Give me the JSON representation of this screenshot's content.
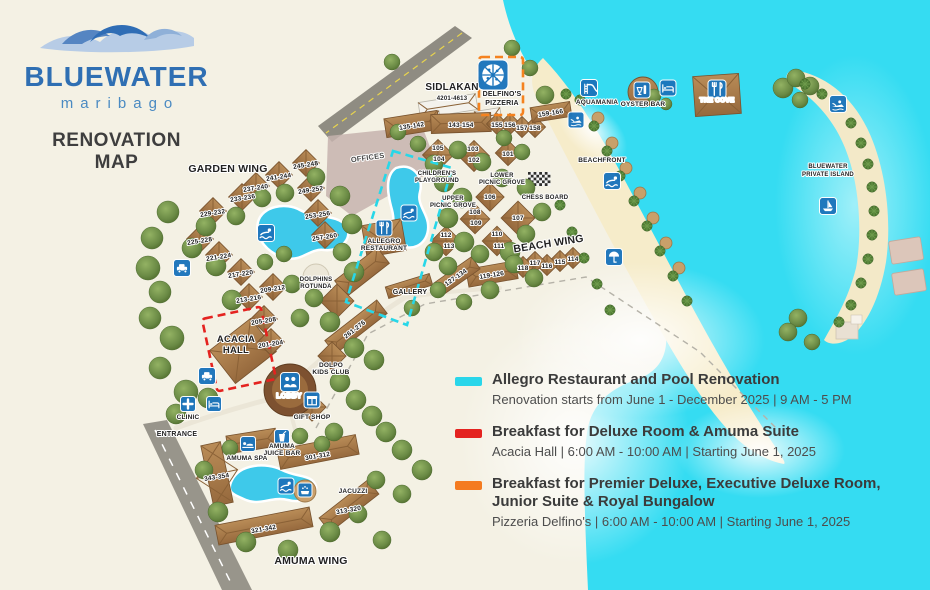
{
  "logo": {
    "brand": "BLUEWATER",
    "sub": "maribago",
    "title1": "RENOVATION",
    "title2": "MAP"
  },
  "legend": {
    "items": [
      {
        "color": "#29d6ea",
        "title": "Allegro Restaurant and Pool Renovation",
        "title2": "",
        "detail": "Renovation starts from June 1 - December 2025  |  9 AM - 5 PM"
      },
      {
        "color": "#e42320",
        "title": "Breakfast for Deluxe Room & Amuma Suite",
        "title2": "",
        "detail": "Acacia Hall  |  6:00 AM - 10:00 AM  |  Starting June 1, 2025"
      },
      {
        "color": "#f47b20",
        "title": "Breakfast for Premier Deluxe, Executive Deluxe Room,",
        "title2": "Junior Suite & Royal Bungalow",
        "detail": "Pizzeria Delfino's  |  6:00 AM - 10:00 AM  |  Starting June 1, 2025"
      }
    ]
  },
  "map": {
    "wings": [
      {
        "text": "GARDEN WING",
        "x": 228,
        "y": 172,
        "size": 10.5
      },
      {
        "text": "BEACH WING",
        "x": 549,
        "y": 247,
        "size": 10.5,
        "rot": -9
      },
      {
        "text": "AMUMA WING",
        "x": 311,
        "y": 564,
        "size": 10.5
      },
      {
        "text": "SIDLAKAN",
        "x": 452,
        "y": 90,
        "size": 10
      },
      {
        "text": "ENTRANCE",
        "x": 177,
        "y": 436,
        "size": 7
      },
      {
        "text": "OFFICES",
        "x": 368,
        "y": 160,
        "size": 7.5,
        "rot": -8,
        "fill": "#4a4a4a"
      },
      {
        "text": "BEACHFRONT",
        "x": 602,
        "y": 162,
        "size": 6.5
      },
      {
        "text": "BLUEWATER",
        "x": 828,
        "y": 168,
        "size": 6
      },
      {
        "text": "PRIVATE ISLAND",
        "x": 828,
        "y": 176,
        "size": 6
      }
    ],
    "areas": [
      {
        "text": "DELFINO'S",
        "x": 502,
        "y": 96,
        "size": 7
      },
      {
        "text": "PIZZERIA",
        "x": 502,
        "y": 105,
        "size": 7
      },
      {
        "text": "AQUAMANIA",
        "x": 597,
        "y": 104,
        "size": 6.5
      },
      {
        "text": "OYSTER BAR",
        "x": 643,
        "y": 106,
        "size": 6.5
      },
      {
        "text": "THE COVE",
        "x": 717,
        "y": 102,
        "size": 6.5,
        "fill": "#ffffff",
        "halo": "#7a5530"
      },
      {
        "text": "CHILDREN'S",
        "x": 437,
        "y": 175,
        "size": 6
      },
      {
        "text": "PLAYGROUND",
        "x": 437,
        "y": 182,
        "size": 6
      },
      {
        "text": "LOWER",
        "x": 502,
        "y": 177,
        "size": 6
      },
      {
        "text": "PICNIC GROVE",
        "x": 502,
        "y": 184,
        "size": 6
      },
      {
        "text": "UPPER",
        "x": 453,
        "y": 200,
        "size": 6
      },
      {
        "text": "PICNIC GROVE",
        "x": 453,
        "y": 207,
        "size": 6
      },
      {
        "text": "CHESS BOARD",
        "x": 545,
        "y": 199,
        "size": 6
      },
      {
        "text": "GALLERY",
        "x": 410,
        "y": 294,
        "size": 7
      },
      {
        "text": "DOLPHINS",
        "x": 316,
        "y": 281,
        "size": 6
      },
      {
        "text": "ROTUNDA",
        "x": 316,
        "y": 288,
        "size": 6
      },
      {
        "text": "ALLEGRO",
        "x": 384,
        "y": 243,
        "size": 6.5
      },
      {
        "text": "RESTAURANT",
        "x": 384,
        "y": 250,
        "size": 6.5
      },
      {
        "text": "ACACIA",
        "x": 236,
        "y": 342,
        "size": 9.5
      },
      {
        "text": "HALL",
        "x": 236,
        "y": 353,
        "size": 9.5
      },
      {
        "text": "LOBBY",
        "x": 289,
        "y": 398,
        "size": 7,
        "fill": "#ffffff",
        "halo": "#5e3c20"
      },
      {
        "text": "DOLPO",
        "x": 331,
        "y": 367,
        "size": 6.5
      },
      {
        "text": "KIDS CLUB",
        "x": 331,
        "y": 374,
        "size": 6.5
      },
      {
        "text": "GIFT SHOP",
        "x": 312,
        "y": 419,
        "size": 6.5
      },
      {
        "text": "CLINIC",
        "x": 188,
        "y": 419,
        "size": 6.5
      },
      {
        "text": "AMUMA SPA",
        "x": 247,
        "y": 460,
        "size": 6.5
      },
      {
        "text": "AMUMA",
        "x": 282,
        "y": 448,
        "size": 6.5
      },
      {
        "text": "JUICE BAR",
        "x": 282,
        "y": 455,
        "size": 6.5
      },
      {
        "text": "JACUZZI",
        "x": 353,
        "y": 493,
        "size": 6.5
      }
    ],
    "rooms": [
      {
        "text": "4201-4613",
        "x": 452,
        "y": 100,
        "size": 6
      },
      {
        "text": "245-248",
        "x": 306,
        "y": 167,
        "rot": -9
      },
      {
        "text": "241-244",
        "x": 279,
        "y": 179,
        "rot": -9
      },
      {
        "text": "237-240",
        "x": 256,
        "y": 190,
        "rot": -9
      },
      {
        "text": "233-236",
        "x": 243,
        "y": 200,
        "rot": -9
      },
      {
        "text": "229-232",
        "x": 213,
        "y": 215,
        "rot": -9
      },
      {
        "text": "225-228",
        "x": 200,
        "y": 243,
        "rot": -9
      },
      {
        "text": "221-224",
        "x": 219,
        "y": 259,
        "rot": -9
      },
      {
        "text": "217-220",
        "x": 241,
        "y": 276,
        "rot": -9
      },
      {
        "text": "249-252",
        "x": 311,
        "y": 192,
        "rot": -9
      },
      {
        "text": "253-256",
        "x": 318,
        "y": 217,
        "rot": -9
      },
      {
        "text": "257-260",
        "x": 325,
        "y": 239,
        "rot": -9
      },
      {
        "text": "209-212",
        "x": 273,
        "y": 291,
        "rot": -9
      },
      {
        "text": "213-216",
        "x": 249,
        "y": 301,
        "rot": -9
      },
      {
        "text": "205-208",
        "x": 264,
        "y": 323,
        "rot": -9
      },
      {
        "text": "201-204",
        "x": 271,
        "y": 346,
        "rot": -9
      },
      {
        "text": "261-276",
        "x": 356,
        "y": 331,
        "rot": -38
      },
      {
        "text": "135-142",
        "x": 412,
        "y": 128,
        "rot": -9
      },
      {
        "text": "143-154",
        "x": 461,
        "y": 127
      },
      {
        "text": "155",
        "x": 497,
        "y": 127
      },
      {
        "text": "156",
        "x": 510,
        "y": 127
      },
      {
        "text": "157",
        "x": 522,
        "y": 130
      },
      {
        "text": "158",
        "x": 535,
        "y": 130
      },
      {
        "text": "159-166",
        "x": 551,
        "y": 115,
        "rot": -9
      },
      {
        "text": "105",
        "x": 438,
        "y": 150
      },
      {
        "text": "104",
        "x": 439,
        "y": 161
      },
      {
        "text": "103",
        "x": 473,
        "y": 151
      },
      {
        "text": "102",
        "x": 474,
        "y": 162
      },
      {
        "text": "101",
        "x": 508,
        "y": 156
      },
      {
        "text": "106",
        "x": 490,
        "y": 199
      },
      {
        "text": "108",
        "x": 475,
        "y": 214
      },
      {
        "text": "109",
        "x": 476,
        "y": 225
      },
      {
        "text": "107",
        "x": 518,
        "y": 220
      },
      {
        "text": "110",
        "x": 497,
        "y": 236
      },
      {
        "text": "111",
        "x": 499,
        "y": 248
      },
      {
        "text": "112",
        "x": 446,
        "y": 237
      },
      {
        "text": "113",
        "x": 449,
        "y": 248
      },
      {
        "text": "114",
        "x": 573,
        "y": 261
      },
      {
        "text": "115",
        "x": 560,
        "y": 264
      },
      {
        "text": "116",
        "x": 547,
        "y": 268
      },
      {
        "text": "117",
        "x": 535,
        "y": 265
      },
      {
        "text": "118",
        "x": 523,
        "y": 270
      },
      {
        "text": "119-126",
        "x": 492,
        "y": 277,
        "rot": -9
      },
      {
        "text": "127-134",
        "x": 457,
        "y": 279,
        "rot": -35
      },
      {
        "text": "301-312",
        "x": 318,
        "y": 458,
        "rot": -10
      },
      {
        "text": "343-354",
        "x": 217,
        "y": 479,
        "rot": -9
      },
      {
        "text": "313-320",
        "x": 349,
        "y": 512,
        "rot": -10
      },
      {
        "text": "321-342",
        "x": 264,
        "y": 531,
        "rot": -10
      }
    ],
    "icons": [
      {
        "name": "pizzeria-icon",
        "glyph": "pizza",
        "x": 493,
        "y": 75,
        "s": 30
      },
      {
        "name": "garden-pool-swim-icon",
        "glyph": "swim",
        "x": 266,
        "y": 233,
        "s": 17
      },
      {
        "name": "allegro-pool-swim-icon",
        "glyph": "swim",
        "x": 409,
        "y": 213,
        "s": 16
      },
      {
        "name": "allegro-restaurant-icon",
        "glyph": "dine",
        "x": 384,
        "y": 228,
        "s": 16
      },
      {
        "name": "aquamania-icon",
        "glyph": "slide",
        "x": 589,
        "y": 88,
        "s": 17
      },
      {
        "name": "oyster-bar-icon",
        "glyph": "drink",
        "x": 642,
        "y": 90,
        "s": 16
      },
      {
        "name": "beach-lounge-icon",
        "glyph": "bed",
        "x": 668,
        "y": 88,
        "s": 16
      },
      {
        "name": "the-cove-restaurant-icon",
        "glyph": "dine",
        "x": 717,
        "y": 89,
        "s": 18
      },
      {
        "name": "jetski-icon",
        "glyph": "jetski",
        "x": 576,
        "y": 120,
        "s": 16
      },
      {
        "name": "beachfront-swim-icon",
        "glyph": "swim",
        "x": 612,
        "y": 181,
        "s": 17
      },
      {
        "name": "beach-umbrella-icon",
        "glyph": "umbrella",
        "x": 614,
        "y": 257,
        "s": 17
      },
      {
        "name": "island-watersports-icon",
        "glyph": "jetski",
        "x": 838,
        "y": 104,
        "s": 17
      },
      {
        "name": "island-boat-icon",
        "glyph": "boat",
        "x": 828,
        "y": 206,
        "s": 17
      },
      {
        "name": "parking-icon",
        "glyph": "car",
        "x": 182,
        "y": 268,
        "s": 17
      },
      {
        "name": "lobby-parking-icon",
        "glyph": "car",
        "x": 207,
        "y": 376,
        "s": 17
      },
      {
        "name": "clinic-icon",
        "glyph": "cross",
        "x": 188,
        "y": 404,
        "s": 15
      },
      {
        "name": "massage-icon",
        "glyph": "bed",
        "x": 214,
        "y": 404,
        "s": 15
      },
      {
        "name": "lobby-icon",
        "glyph": "people",
        "x": 290,
        "y": 382,
        "s": 19
      },
      {
        "name": "gift-shop-icon",
        "glyph": "gift",
        "x": 312,
        "y": 400,
        "s": 16
      },
      {
        "name": "juice-bar-icon",
        "glyph": "juice",
        "x": 282,
        "y": 437,
        "s": 15
      },
      {
        "name": "spa-icon",
        "glyph": "spa",
        "x": 248,
        "y": 444,
        "s": 15
      },
      {
        "name": "amuma-pool-swim-icon",
        "glyph": "swim",
        "x": 286,
        "y": 486,
        "s": 16
      },
      {
        "name": "jacuzzi-icon",
        "glyph": "bubbles",
        "x": 305,
        "y": 490,
        "s": 14
      }
    ],
    "zones": [
      {
        "name": "allegro-renovation-zone",
        "color": "#27d7e8",
        "shape": "polygon",
        "points": "393,151 452,168 407,325 346,302"
      },
      {
        "name": "acacia-breakfast-zone",
        "color": "#e42320",
        "shape": "rect",
        "x": 239,
        "y": 349,
        "w": 60,
        "h": 74,
        "rot": -12
      },
      {
        "name": "delfinos-breakfast-zone",
        "color": "#f5821f",
        "shape": "rect",
        "x": 501,
        "y": 86,
        "w": 44,
        "h": 58,
        "rot": 0
      }
    ]
  }
}
